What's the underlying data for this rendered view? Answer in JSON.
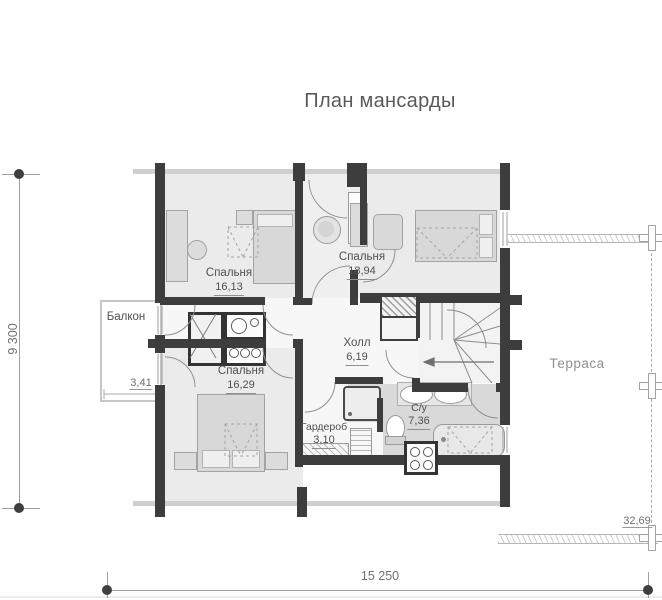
{
  "title": "План мансарды",
  "plan": {
    "rooms": [
      {
        "id": "bedroom-1",
        "name": "Спальня",
        "area": "16,13"
      },
      {
        "id": "bedroom-2",
        "name": "Спальня",
        "area": "18,94"
      },
      {
        "id": "bedroom-3",
        "name": "Спальня",
        "area": "16,29"
      },
      {
        "id": "hall",
        "name": "Холл",
        "area": "6,19"
      },
      {
        "id": "bathroom",
        "name": "С/у",
        "area": "7,36"
      },
      {
        "id": "wardrobe",
        "name": "Гардероб",
        "area": "3,10"
      },
      {
        "id": "balcony",
        "name": "Балкон",
        "area": "3,41"
      },
      {
        "id": "terrace",
        "name": "Терраса",
        "area": "32,69"
      }
    ],
    "dimensions": {
      "overall_width_mm": "15 250",
      "overall_height_mm": "9 300"
    },
    "colors": {
      "wall": "#3d3d3d",
      "room_floor": "#ebebeb",
      "bath_floor": "#d9d9d9",
      "eaves_line": "#cfcfcf",
      "text": "#4f4f4f",
      "dimension_text": "#707070"
    }
  }
}
